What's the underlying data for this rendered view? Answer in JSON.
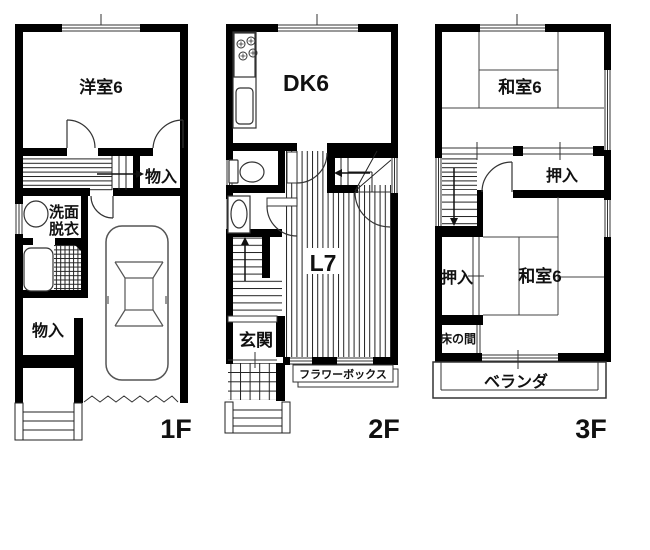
{
  "drawing_type": "floor-plan",
  "colors": {
    "wall": "#000000",
    "thin_line": "#333333",
    "fixture_line": "#555555",
    "background": "#ffffff"
  },
  "floors": [
    {
      "id": "1f",
      "label": "1F",
      "rooms": {
        "western_room": "洋室6",
        "storage_mid": "物入",
        "washroom_line1": "洗面",
        "washroom_line2": "脱衣",
        "storage_bottom": "物入"
      }
    },
    {
      "id": "2f",
      "label": "2F",
      "rooms": {
        "dining_kitchen": "DK6",
        "living": "L7",
        "entrance": "玄関",
        "flower_box": "フラワーボックス"
      }
    },
    {
      "id": "3f",
      "label": "3F",
      "rooms": {
        "tatami_top": "和室6",
        "closet_top": "押入",
        "closet_bottom": "押入",
        "tatami_bottom": "和室6",
        "tokonoma": "床の間",
        "veranda": "ベランダ"
      }
    }
  ]
}
